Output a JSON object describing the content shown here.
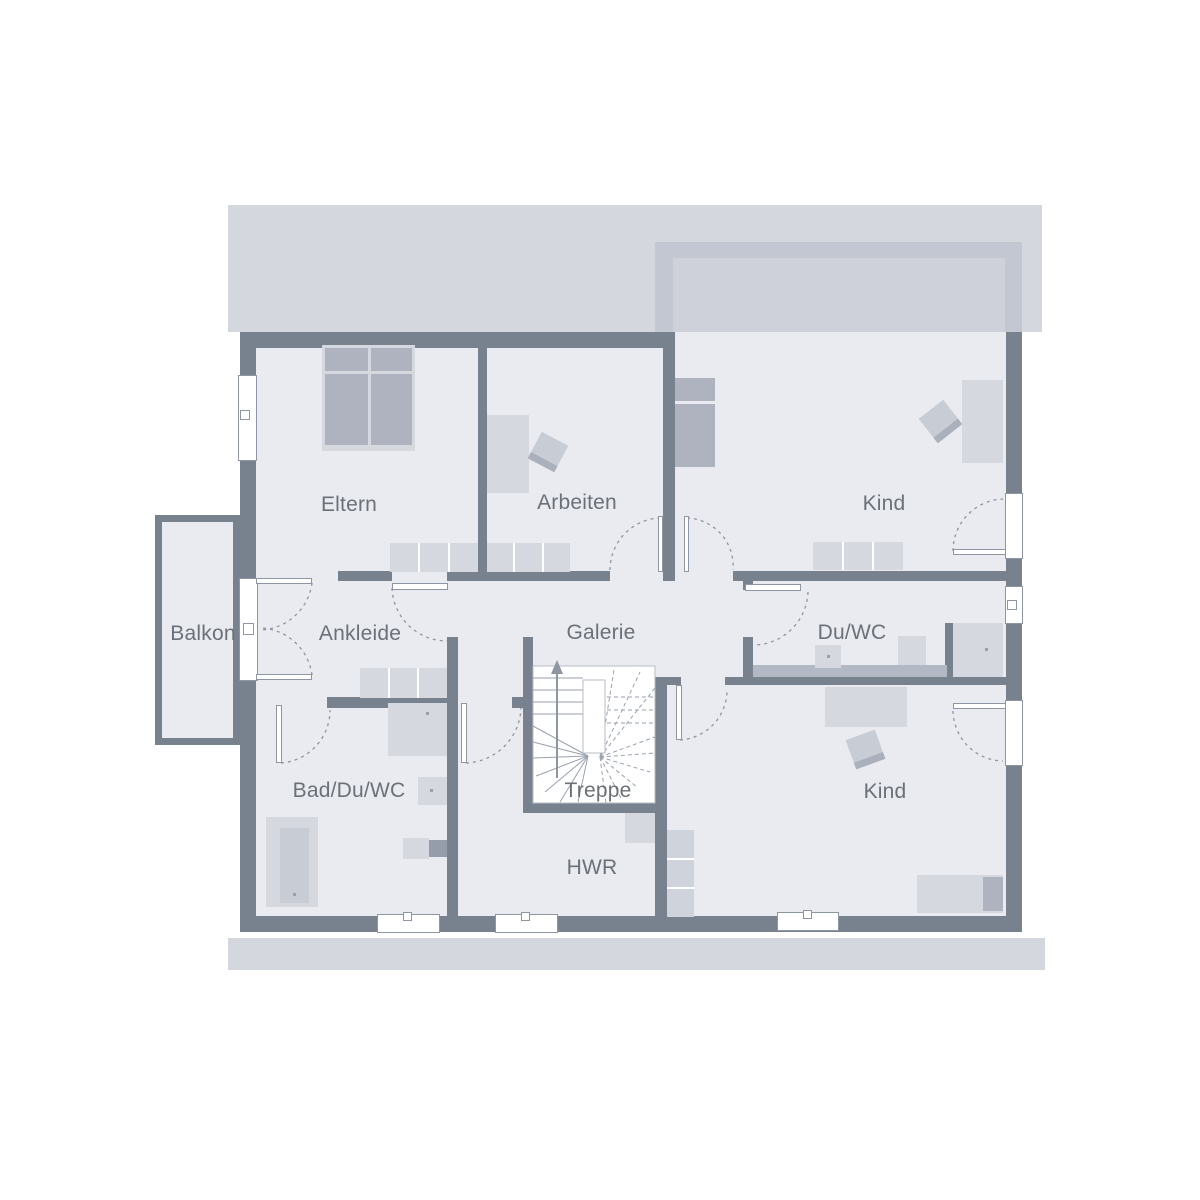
{
  "plan": {
    "title": "Obergeschoss Grundriss",
    "rooms": [
      {
        "id": "eltern",
        "label": "Eltern"
      },
      {
        "id": "arbeiten",
        "label": "Arbeiten"
      },
      {
        "id": "kind-oben",
        "label": "Kind"
      },
      {
        "id": "balkon",
        "label": "Balkon"
      },
      {
        "id": "ankleide",
        "label": "Ankleide"
      },
      {
        "id": "galerie",
        "label": "Galerie"
      },
      {
        "id": "du-wc",
        "label": "Du/WC"
      },
      {
        "id": "bad-du-wc",
        "label": "Bad/Du/WC"
      },
      {
        "id": "treppe",
        "label": "Treppe"
      },
      {
        "id": "hwr",
        "label": "HWR"
      },
      {
        "id": "kind-unten",
        "label": "Kind"
      }
    ],
    "colors": {
      "wall": "#78828f",
      "floor": "#e9ebf0",
      "roof_band": "#d4d7de",
      "roof_band_dark": "#c3c7d1",
      "furniture_light": "#d5d8df",
      "furniture_dark": "#aeb3bf",
      "label_text": "#6b7178",
      "swing_arc": "#8d96a2"
    }
  }
}
